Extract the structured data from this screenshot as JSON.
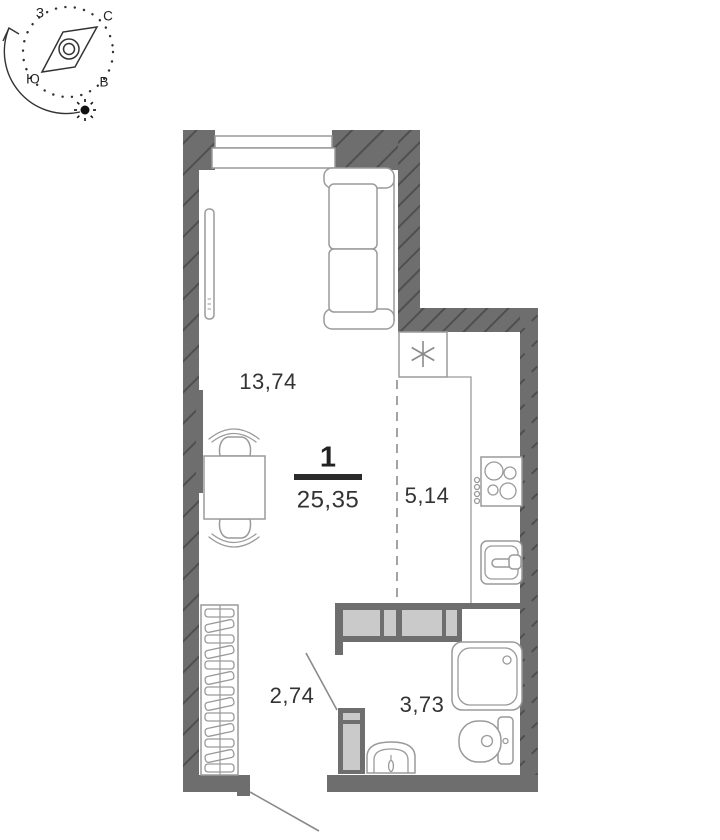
{
  "compass": {
    "letters": {
      "west": "З",
      "north": "С",
      "south": "Ю",
      "east": "В"
    }
  },
  "apartment": {
    "rooms_count": "1",
    "total_area": "25,35"
  },
  "rooms": [
    {
      "id": "living-room",
      "area": "13,74"
    },
    {
      "id": "kitchen",
      "area": "5,14"
    },
    {
      "id": "hallway",
      "area": "2,74"
    },
    {
      "id": "bathroom",
      "area": "3,73"
    }
  ],
  "colors": {
    "wall": "#6e6e6e",
    "wall_hatch": "#4f4f4f",
    "partition_fill": "#cacaca",
    "furniture_stroke": "#9a9a9a",
    "dashed_line": "#a3a3a3",
    "text": "#333333",
    "background": "#ffffff"
  }
}
